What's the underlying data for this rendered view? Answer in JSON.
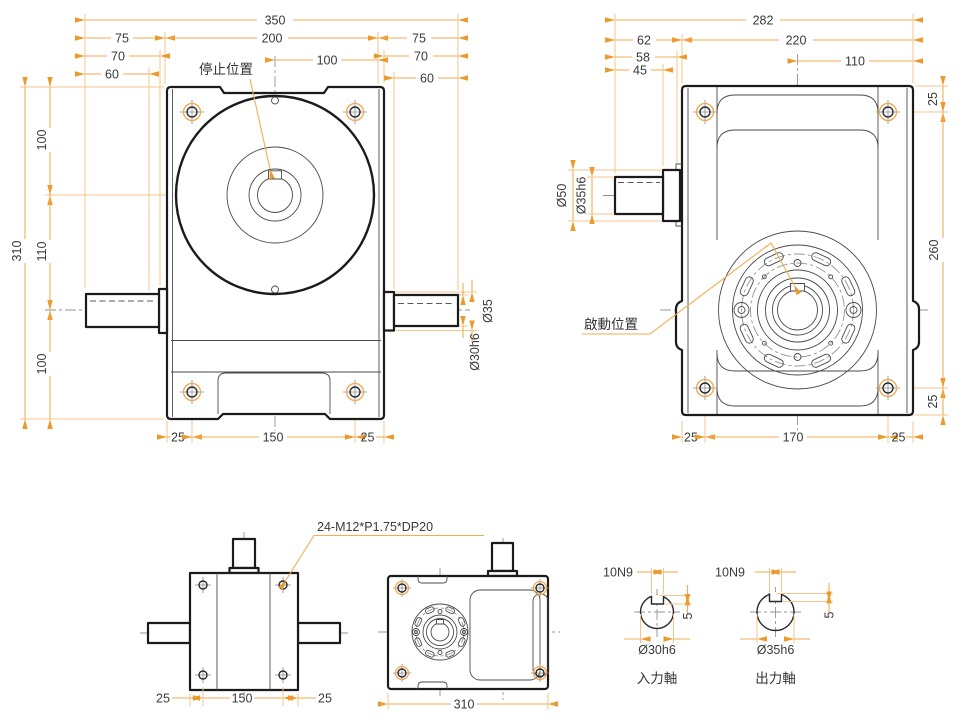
{
  "drawing_type": "technical-drawing",
  "colors": {
    "dimension": "#F3AC51",
    "arrow": "#EC9A2C",
    "outline": "#1b1b1b",
    "centerline": "#949494",
    "text": "#3a3a3a"
  },
  "front_view": {
    "stop_position_label": "停止位置",
    "dim_overall_width": "350",
    "dim_left_shaft": "75",
    "dim_body_width": "200",
    "dim_right_shaft": "75",
    "dim_left_70": "70",
    "dim_center_to_edge": "100",
    "dim_right_70": "70",
    "dim_left_60": "60",
    "dim_right_60": "60",
    "dim_overall_height": "310",
    "dim_top_to_center": "100",
    "dim_center_to_shaft": "110",
    "dim_shaft_to_bottom": "100",
    "dim_foot_left": "25",
    "dim_foot_span": "150",
    "dim_foot_right": "25",
    "dim_shaft_step_dia": "Ø35",
    "dim_shaft_dia": "Ø30h6"
  },
  "side_view": {
    "start_position_label": "啟動位置",
    "dim_overall_width": "282",
    "dim_shaft_protrusion": "62",
    "dim_body_depth": "220",
    "dim_58": "58",
    "dim_45": "45",
    "dim_center_to_edge": "110",
    "dim_top_hole_offset": "25",
    "dim_hole_span_vertical": "260",
    "dim_bottom_hole_offset": "25",
    "dim_foot_left": "25",
    "dim_foot_span": "170",
    "dim_foot_right": "25",
    "dim_collar_dia": "Ø50",
    "dim_shaft_dia": "Ø35h6"
  },
  "top_view": {
    "thread_note": "24-M12*P1.75*DP20",
    "dim_foot_left": "25",
    "dim_foot_span": "150",
    "dim_foot_right": "25"
  },
  "side_small_view": {
    "dim_overall": "310"
  },
  "input_shaft_section": {
    "keyway_width": "10N9",
    "keyway_depth": "5",
    "shaft_dia": "Ø30h6",
    "title": "入力軸"
  },
  "output_shaft_section": {
    "keyway_width": "10N9",
    "keyway_depth": "5",
    "shaft_dia": "Ø35h6",
    "title": "出力軸"
  }
}
